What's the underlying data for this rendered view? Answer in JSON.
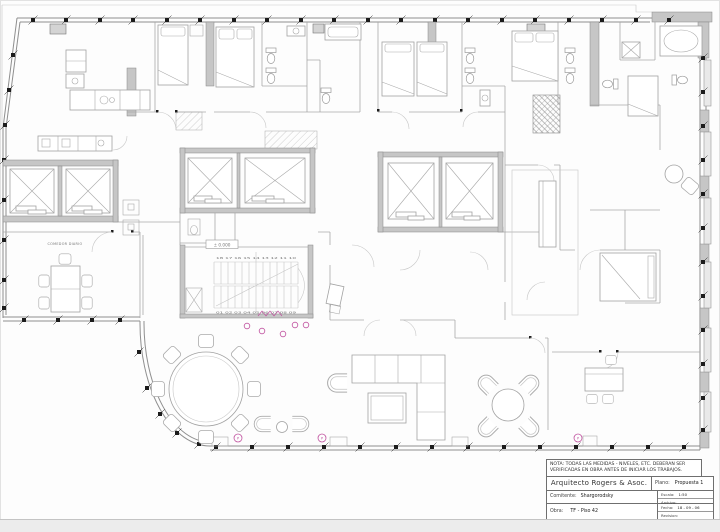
{
  "colors": {
    "marker": "#c0519f",
    "line": "#a9a9a9",
    "wall_fill": "#c6c6c6"
  },
  "plan": {
    "labels": {
      "comedor_diario": "COMEDOR DIARIO",
      "level": "± 0.000",
      "upper_steps": "18 17 16 15 14 13 12 11 10",
      "lower_steps": "01 02 03 04 05 06 07 08 09",
      "marker_letter": "P"
    }
  },
  "title_block": {
    "note_line1": "NOTA: TODAS LAS MEDIDAS - NIVELES, ETC. DEBERAN SER",
    "note_line2": "VERIFICADAS EN OBRA ANTES DE INICIAR LOS TRABAJOS.",
    "architect": "Arquitecto Rogers & Asoc.",
    "fields": {
      "plano_label": "Plano:",
      "plano": "Propuesta 1",
      "comitente_label": "Comitente:",
      "comitente": "Shargorodsky",
      "escala_label": "Escala:",
      "escala": "1:50",
      "archivo_label": "Archivo:",
      "obra_label": "Obra:",
      "obra": "TF - Piso 42",
      "fecha_label": "Fecha:",
      "fecha": "18 - 09 - 06",
      "revision_label": "Revision:"
    }
  }
}
